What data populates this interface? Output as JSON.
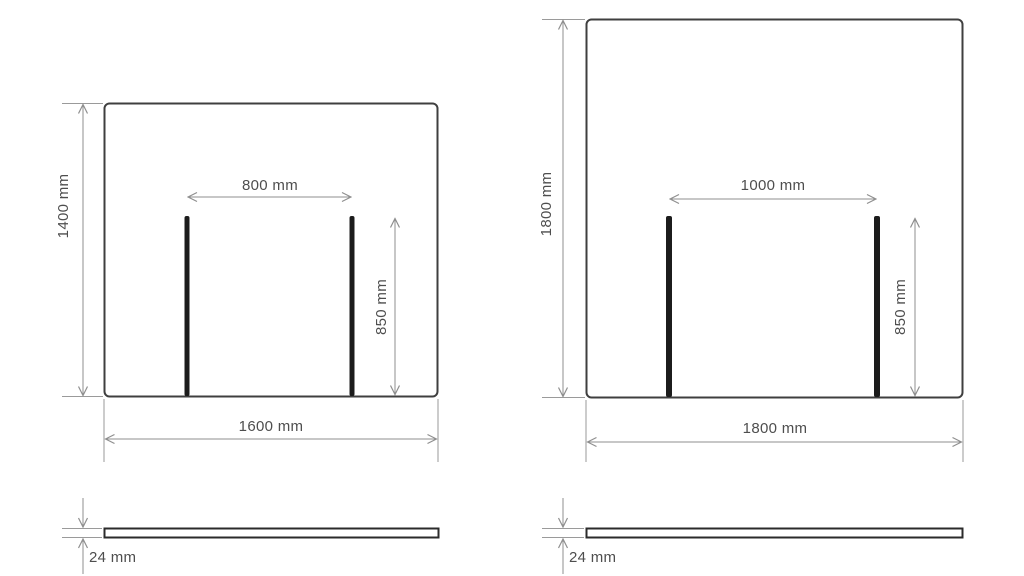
{
  "page": {
    "background": "#ffffff"
  },
  "colors": {
    "panel_outline": "#3f3f3f",
    "leg": "#1c1c1c",
    "dimension_line": "#8f8f8f",
    "label_text": "#4e4e4e"
  },
  "diagrams": [
    {
      "id": "panel-1600",
      "width_label": "1600 mm",
      "height_label": "1400 mm",
      "leg_spacing_label": "800 mm",
      "leg_height_label": "850 mm",
      "thickness_label": "24 mm"
    },
    {
      "id": "panel-1800",
      "width_label": "1800 mm",
      "height_label": "1800 mm",
      "leg_spacing_label": "1000 mm",
      "leg_height_label": "850 mm",
      "thickness_label": "24 mm"
    }
  ]
}
